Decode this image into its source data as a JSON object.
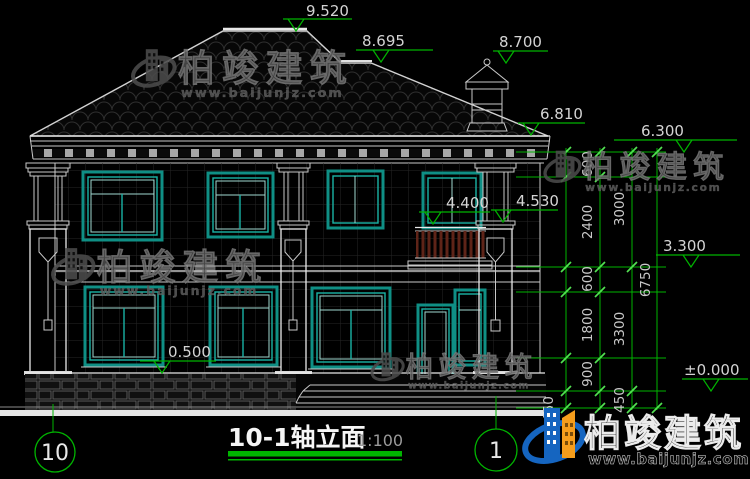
{
  "title_block": {
    "title": "10-1轴立面",
    "scale": "1:100"
  },
  "axes": {
    "left": "10",
    "right": "1"
  },
  "elevation_markers": {
    "ridge": "9.520",
    "roof_break": "8.695",
    "chimney_top": "8.700",
    "right_eave": "6.810",
    "main_eave": "6.300",
    "second_floor": "3.300",
    "ground": "±0.000",
    "balcony_rail": "4.400",
    "column_capital": "4.530",
    "base_top": "0.500"
  },
  "dimensions": {
    "inner_chain": [
      "600",
      "2400",
      "600",
      "1800",
      "900",
      "450"
    ],
    "mid_chain": [
      "3000",
      "3300"
    ],
    "total": "6750",
    "plinth": "450"
  },
  "watermark": {
    "name": "柏竣建筑",
    "url": "www.baijunjz.com"
  },
  "logo": {
    "name": "柏竣建筑",
    "url": "www.baijunjz.com"
  }
}
